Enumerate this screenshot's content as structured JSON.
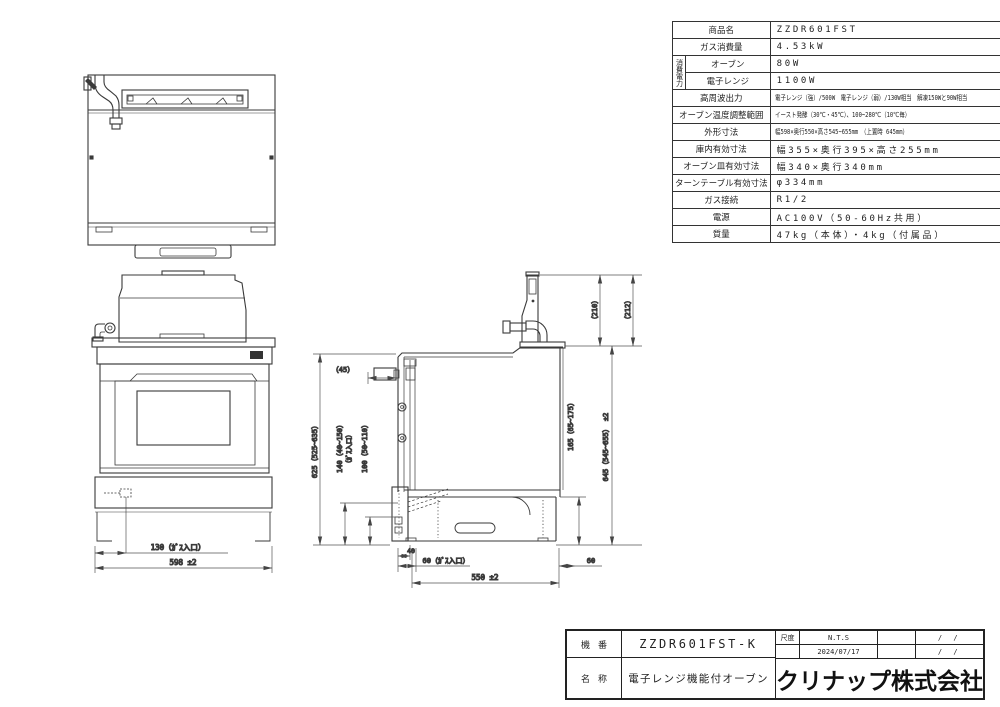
{
  "spec_table": {
    "power_group_label": "消費電力",
    "rows": [
      {
        "label": "商品名",
        "value": "ZZDR601FST"
      },
      {
        "label": "ガス消費量",
        "value": "4.53kW"
      },
      {
        "label": "オーブン",
        "value": "80W"
      },
      {
        "label": "電子レンジ",
        "value": "1100W"
      },
      {
        "label": "高周波出力",
        "value": "電子レンジ（強）/500W　電子レンジ（弱）/130W相当　解凍150Wと90W相当"
      },
      {
        "label": "オーブン温度調整範囲",
        "value": "イースト発酵（30℃・45℃）、100~280℃（10℃毎）"
      },
      {
        "label": "外形寸法",
        "value": "幅598×奥行550×高さ545~655mm　（上置時 645mm）"
      },
      {
        "label": "庫内有効寸法",
        "value": "幅355×奥行395×高さ255mm"
      },
      {
        "label": "オーブン皿有効寸法",
        "value": "幅340×奥行340mm"
      },
      {
        "label": "ターンテーブル有効寸法",
        "value": "φ334mm"
      },
      {
        "label": "ガス接続",
        "value": "R1/2"
      },
      {
        "label": "電源",
        "value": "AC100V（50-60Hz共用）"
      },
      {
        "label": "質量",
        "value": "47kg（本体）・4kg（付属品）"
      }
    ]
  },
  "front_view": {
    "dim_gas_inlet": "130（ｶﾞｽ入口）",
    "dim_width": "598 ±2"
  },
  "side_view": {
    "dim_knob": "（45）",
    "dim_height_left": "625（525~635）",
    "dim_gas_height": "140（40~150）",
    "dim_gas_height_note": "（ｶﾞｽ入口）",
    "dim_lower": "100（50~110）",
    "dim_rear_165": "165（65~175）",
    "dim_height_right": "645（545~655）  ±2",
    "dim_top_210": "（210）",
    "dim_top_212": "（212）",
    "dim_40": "40",
    "dim_60_gas": "60（ｶﾞｽ入口）",
    "dim_depth": "550 ±2",
    "dim_60_right": "60"
  },
  "title_block": {
    "model_label": "機番",
    "model_value": "ZZDR601FST-K",
    "name_label": "名称",
    "name_value": "電子レンジ機能付オーブン",
    "scale_label": "尺度",
    "scale_value": "N.T.S",
    "date": "2024/07/17",
    "slash_top": "/ /",
    "slash_bottom": "/ /",
    "company": "クリナップ株式会社"
  }
}
